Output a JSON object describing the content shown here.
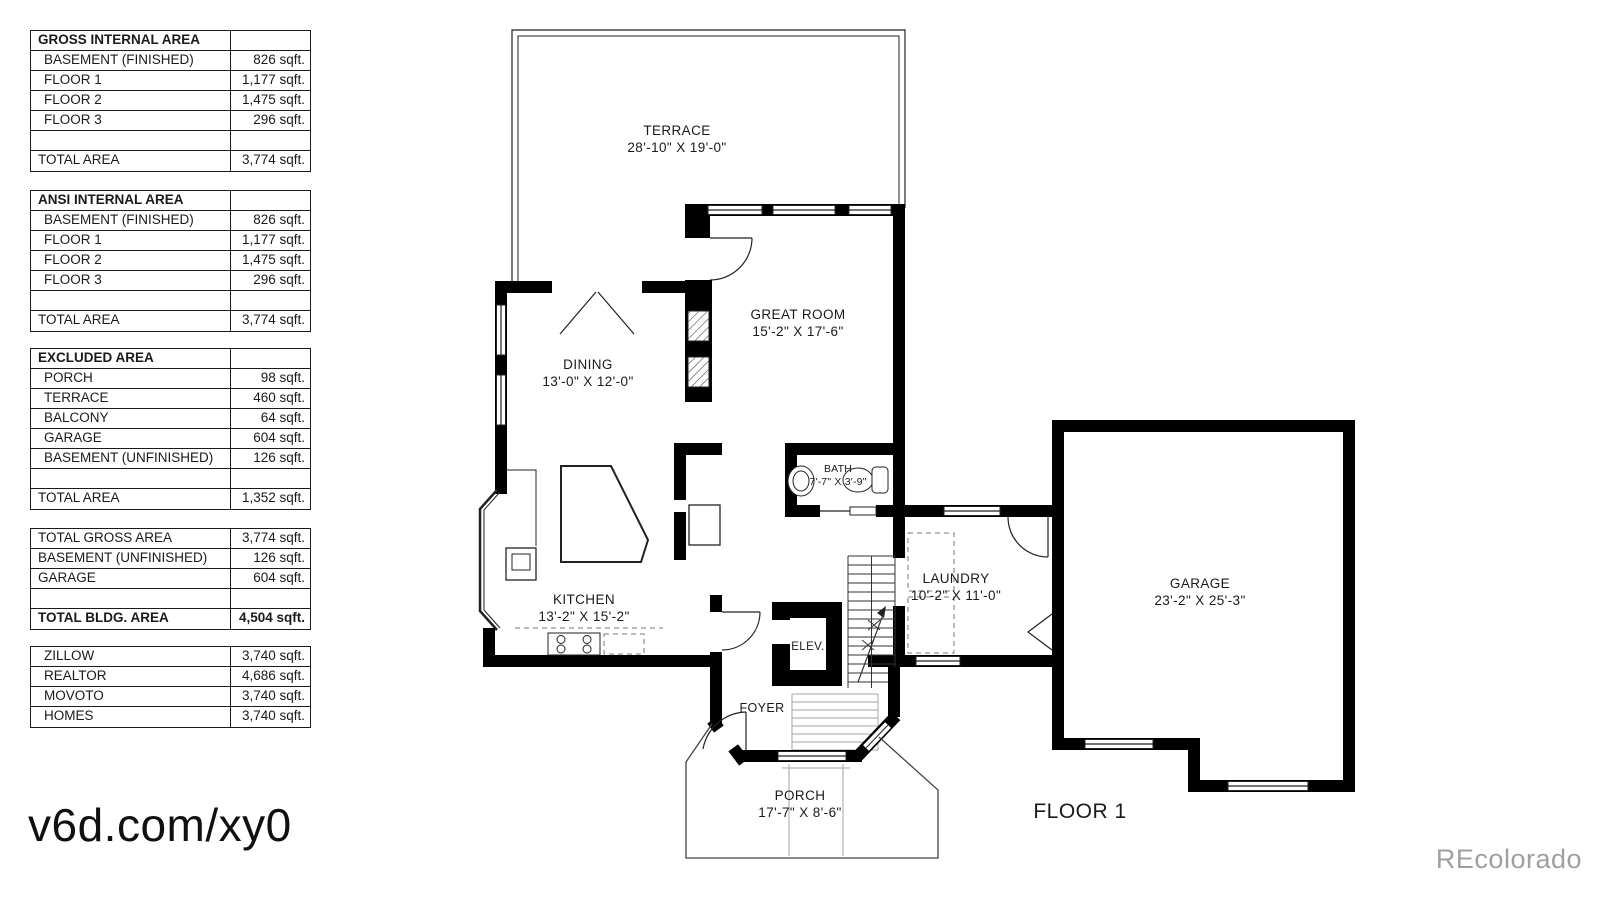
{
  "tables": {
    "gross": {
      "title": "GROSS INTERNAL AREA",
      "rows": [
        {
          "label": "BASEMENT (FINISHED)",
          "value": "826 sqft."
        },
        {
          "label": "FLOOR 1",
          "value": "1,177 sqft."
        },
        {
          "label": "FLOOR 2",
          "value": "1,475 sqft."
        },
        {
          "label": "FLOOR 3",
          "value": "296 sqft."
        }
      ],
      "total_label": "TOTAL AREA",
      "total_value": "3,774 sqft."
    },
    "ansi": {
      "title": "ANSI INTERNAL AREA",
      "rows": [
        {
          "label": "BASEMENT (FINISHED)",
          "value": "826 sqft."
        },
        {
          "label": "FLOOR 1",
          "value": "1,177 sqft."
        },
        {
          "label": "FLOOR 2",
          "value": "1,475 sqft."
        },
        {
          "label": "FLOOR 3",
          "value": "296 sqft."
        }
      ],
      "total_label": "TOTAL AREA",
      "total_value": "3,774 sqft."
    },
    "excluded": {
      "title": "EXCLUDED AREA",
      "rows": [
        {
          "label": "PORCH",
          "value": "98 sqft."
        },
        {
          "label": "TERRACE",
          "value": "460 sqft."
        },
        {
          "label": "BALCONY",
          "value": "64 sqft."
        },
        {
          "label": "GARAGE",
          "value": "604 sqft."
        },
        {
          "label": "BASEMENT (UNFINISHED)",
          "value": "126 sqft."
        }
      ],
      "total_label": "TOTAL AREA",
      "total_value": "1,352 sqft."
    },
    "summary": {
      "rows": [
        {
          "label": "TOTAL GROSS AREA",
          "value": "3,774 sqft."
        },
        {
          "label": "BASEMENT (UNFINISHED)",
          "value": "126 sqft."
        },
        {
          "label": "GARAGE",
          "value": "604 sqft."
        }
      ],
      "total_label": "TOTAL BLDG. AREA",
      "total_value": "4,504 sqft."
    },
    "providers": {
      "rows": [
        {
          "label": "ZILLOW",
          "value": "3,740 sqft."
        },
        {
          "label": "REALTOR",
          "value": "4,686 sqft."
        },
        {
          "label": "MOVOTO",
          "value": "3,740 sqft."
        },
        {
          "label": "HOMES",
          "value": "3,740 sqft."
        }
      ]
    }
  },
  "plan": {
    "rooms": {
      "terrace": {
        "name": "TERRACE",
        "dims": "28'-10\" X 19'-0\""
      },
      "great_room": {
        "name": "GREAT ROOM",
        "dims": "15'-2\" X 17'-6\""
      },
      "dining": {
        "name": "DINING",
        "dims": "13'-0\" X 12'-0\""
      },
      "kitchen": {
        "name": "KITCHEN",
        "dims": "13'-2\" X 15'-2\""
      },
      "bath": {
        "name": "BATH",
        "dims": "7'-7\" X 3'-9\""
      },
      "laundry": {
        "name": "LAUNDRY",
        "dims": "10'-2\" X 11'-0\""
      },
      "garage": {
        "name": "GARAGE",
        "dims": "23'-2\" X 25'-3\""
      },
      "elevator": {
        "name": "ELEV."
      },
      "foyer": {
        "name": "FOYER"
      },
      "porch": {
        "name": "PORCH",
        "dims": "17'-7\" X 8'-6\""
      }
    },
    "floor_label": "FLOOR 1"
  },
  "watermarks": {
    "url_tag": "v6d.com/xy0",
    "brand": "REcolorado"
  },
  "colors": {
    "wall": "#000000",
    "line": "#222222",
    "gray": "#a0a0a0"
  }
}
